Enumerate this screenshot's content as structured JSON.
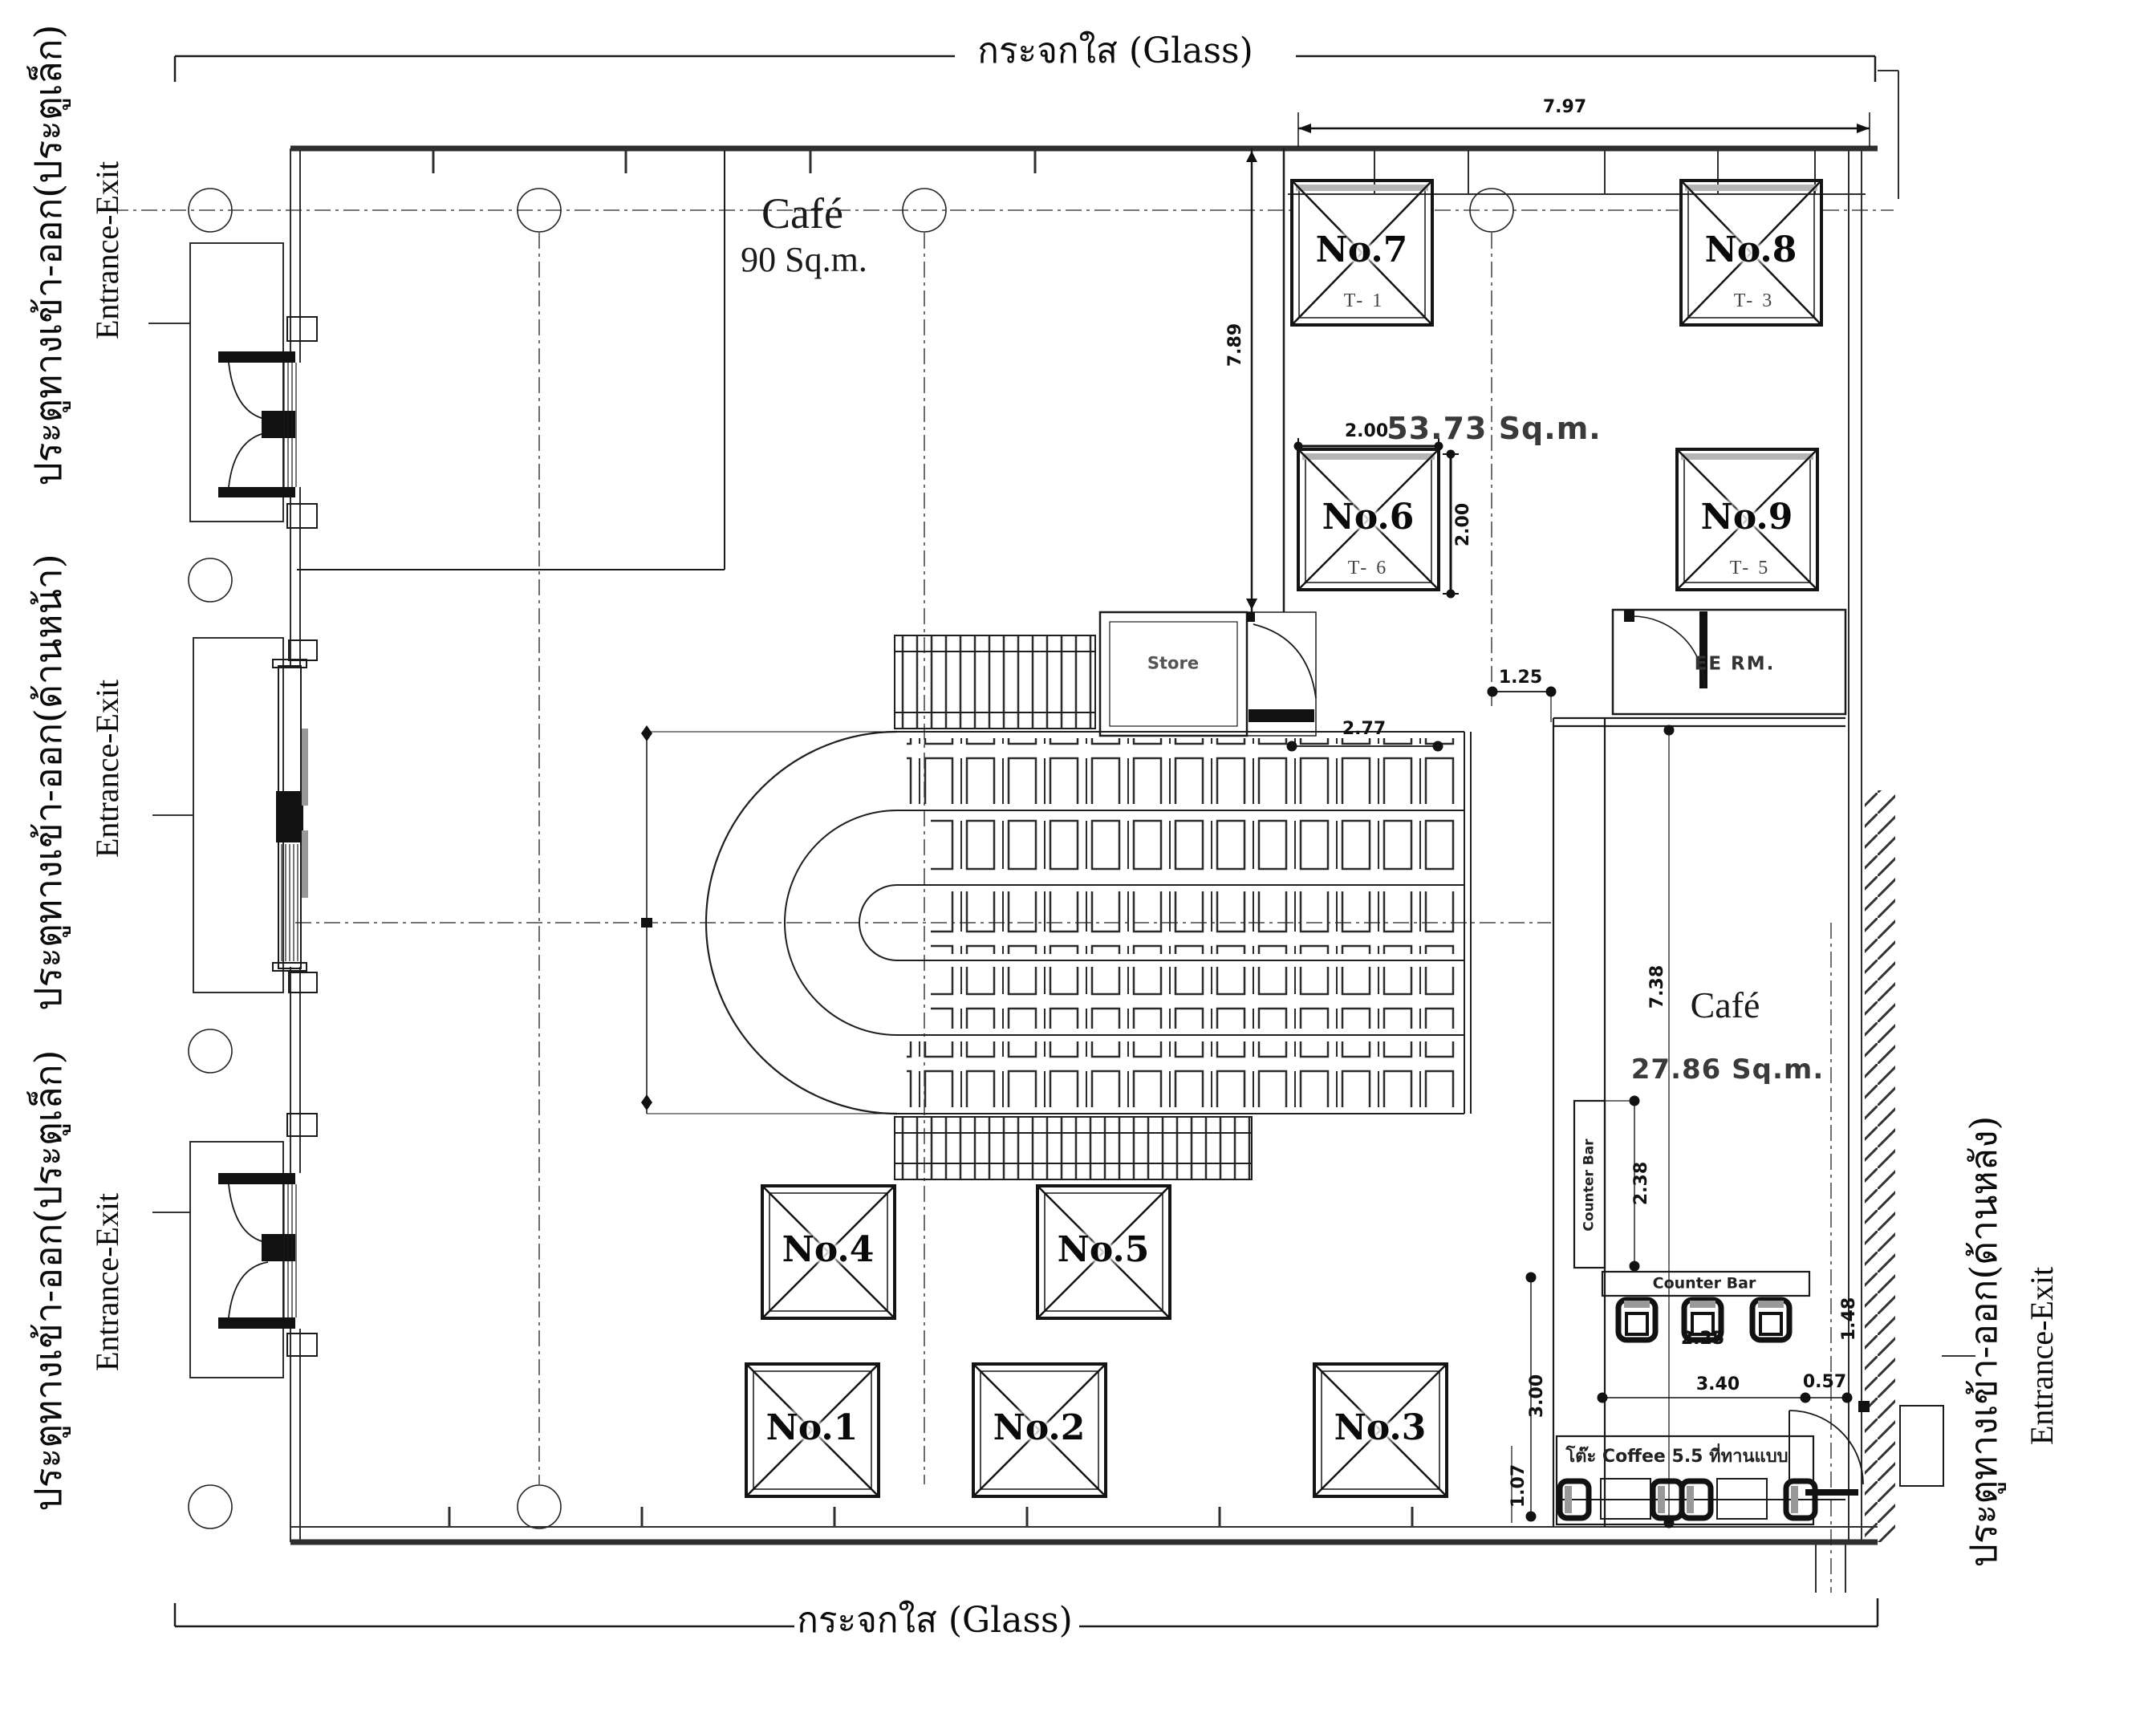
{
  "glass": {
    "top": "กระจกใส (Glass)",
    "bottom": "กระจกใส (Glass)"
  },
  "entrances": {
    "left_top": {
      "thai": "ประตูทางเข้า-ออก(ประตูเล็ก)",
      "eng": "Entrance-Exit"
    },
    "left_front": {
      "thai": "ประตูทางเข้า-ออก(ด้านหน้า)",
      "eng": "Entrance-Exit"
    },
    "left_bottom": {
      "thai": "ประตูทางเข้า-ออก(ประตูเล็ก)",
      "eng": "Entrance-Exit"
    },
    "right_back": {
      "thai": "ประตูทางเข้า-ออก(ด้านหลัง)",
      "eng": "Entrance-Exit"
    }
  },
  "rooms": {
    "cafe_main": {
      "name": "Café",
      "area": "90 Sq.m."
    },
    "zone": {
      "area": "53.73 Sq.m."
    },
    "cafe_small": {
      "name": "Café",
      "area": "27.86 Sq.m."
    },
    "store": {
      "name": "Store"
    },
    "ee": {
      "name": "EE RM."
    },
    "counter_vertical": "Counter Bar",
    "counter_horizontal": "Counter Bar",
    "coffee": "โต๊ะ Coffee 5.5 ที่ทานแบบ"
  },
  "columns": [
    {
      "label": "No.1",
      "sub": ""
    },
    {
      "label": "No.2",
      "sub": ""
    },
    {
      "label": "No.3",
      "sub": ""
    },
    {
      "label": "No.4",
      "sub": ""
    },
    {
      "label": "No.5",
      "sub": ""
    },
    {
      "label": "No.6",
      "sub": "T- 6"
    },
    {
      "label": "No.7",
      "sub": "T- 1"
    },
    {
      "label": "No.8",
      "sub": "T- 3"
    },
    {
      "label": "No.9",
      "sub": "T- 5"
    }
  ],
  "dims": {
    "top": "7.97",
    "shaft": "7.89",
    "no6_w": "2.00",
    "no6_h": "2.00",
    "ee_off": "1.25",
    "esc": "2.77",
    "cafe_h": "7.38",
    "counter_len": "2.38",
    "stool": "2.25",
    "bar_w": "3.40",
    "gap": "0.57",
    "coffee_w": "3.00",
    "coffee_h": "1.07",
    "wall_r": "1.48"
  }
}
